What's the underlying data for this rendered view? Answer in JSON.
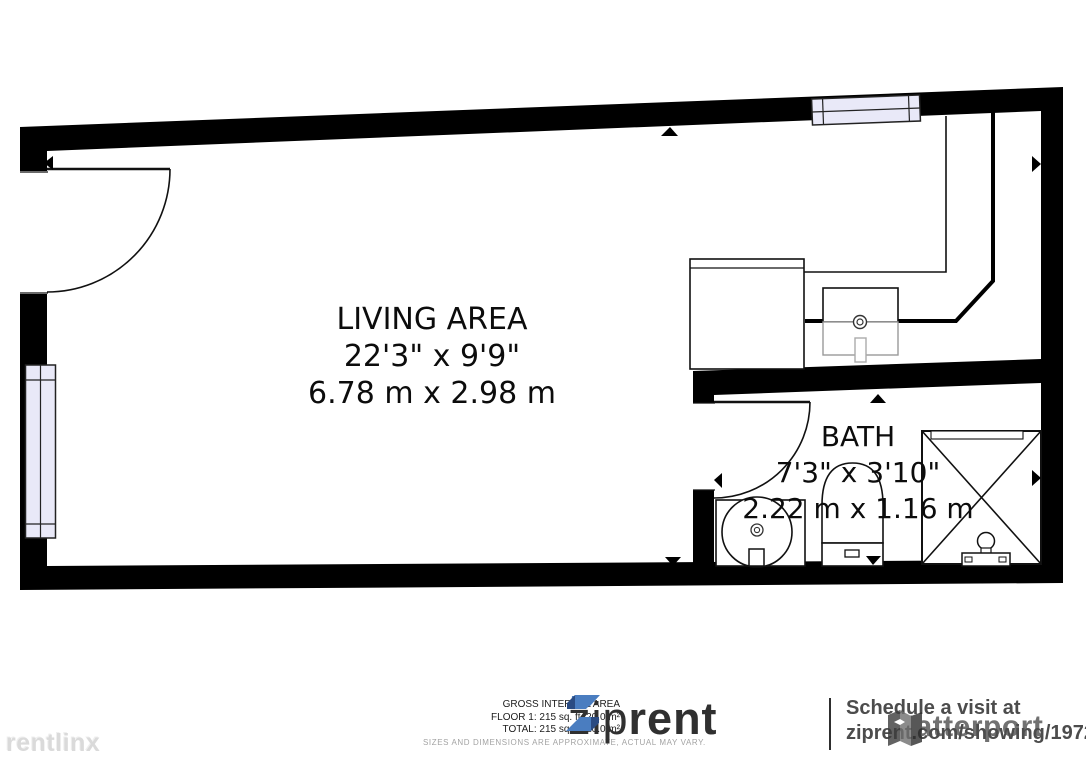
{
  "floorplan": {
    "rooms": [
      {
        "name": "LIVING AREA",
        "dim_imperial": "22'3\" x 9'9\"",
        "dim_metric": "6.78 m x 2.98 m"
      },
      {
        "name": "BATH",
        "dim_imperial": "7'3\" x 3'10\"",
        "dim_metric": "2.22 m x 1.16 m"
      }
    ],
    "fixture_icons": [
      "entry-door-icon",
      "bath-door-icon",
      "window-icon",
      "kitchen-counter-icon",
      "kitchen-sink-icon",
      "bath-sink-icon",
      "toilet-icon",
      "shower-icon",
      "direction-arrow-icon"
    ],
    "wall_color": "#000000",
    "window_fill": "#e9e9f8"
  },
  "footer": {
    "area_summary": {
      "title": "GROSS INTERNAL AREA",
      "floor1": "FLOOR 1: 215 sq. ft, 20.0 m²",
      "total": "TOTAL: 215 sq. ft, 20.0 m²",
      "disclaimer": "SIZES AND DIMENSIONS ARE APPROXIMATE, ACTUAL MAY VARY."
    },
    "brand": {
      "name_light": "zip",
      "name_bold": "rent",
      "icon_blue": "#4a7dc0",
      "icon_navy": "#2a4b82"
    },
    "cta": {
      "line1": "Schedule a visit at",
      "line2": "ziprent.com/showing/19722"
    }
  },
  "watermarks": {
    "rentlinx": "rentlinx",
    "matterport": "Matterport"
  }
}
